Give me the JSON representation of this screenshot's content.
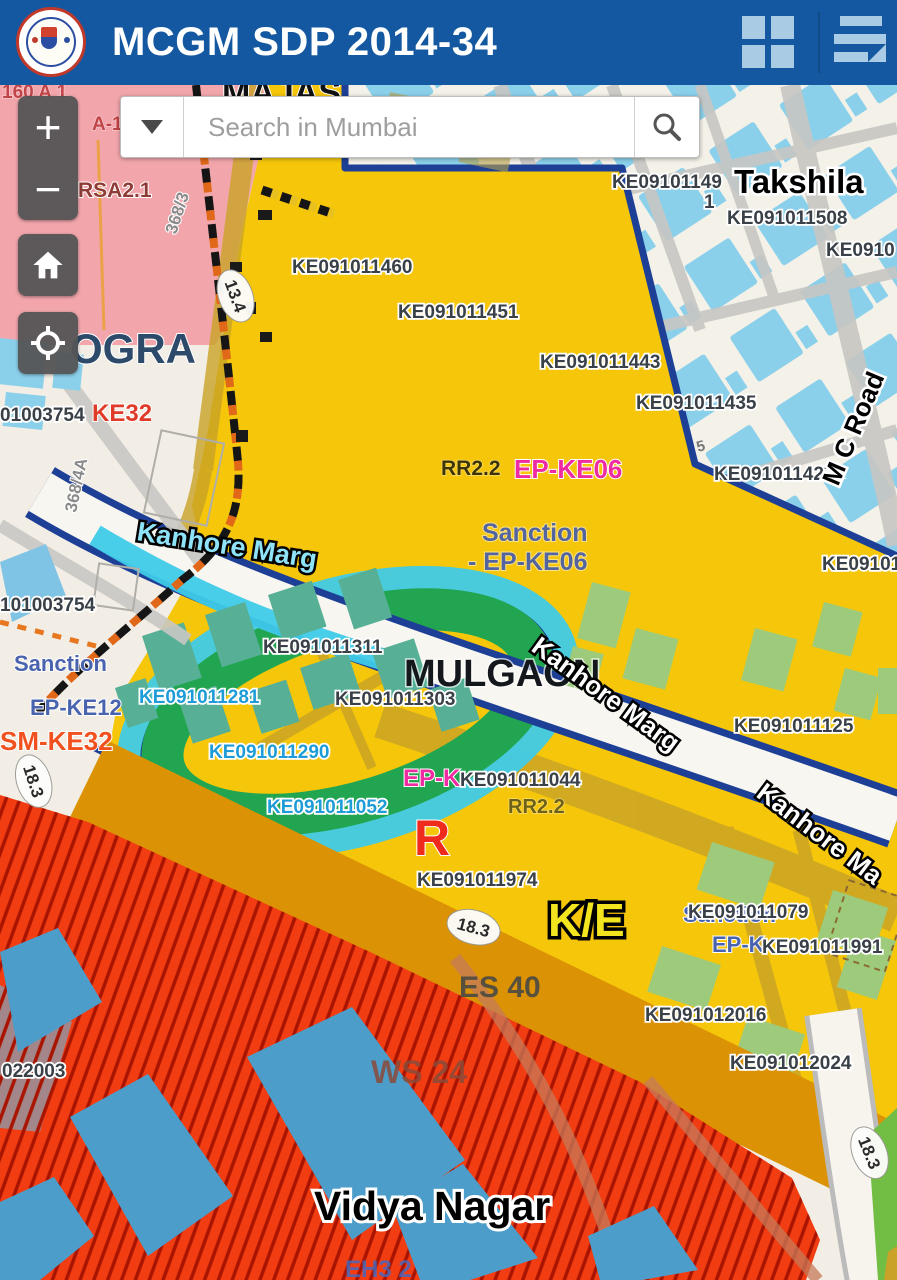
{
  "header": {
    "title": "MCGM SDP 2014-34",
    "grid_icon": "grid-icon",
    "menu_icon": "menu-icon",
    "bg_color": "#1358A0",
    "icon_color": "#A9CBE3"
  },
  "search": {
    "placeholder": "Search in Mumbai",
    "dropdown_icon": "chevron-down-icon",
    "search_icon": "search-icon"
  },
  "controls": {
    "zoom_in": "+",
    "zoom_out": "−",
    "home_icon": "home-icon",
    "locate_icon": "locate-icon"
  },
  "palette": {
    "zone_yellow": "#F5C60A",
    "zone_pink": "#F2A6AC",
    "zone_red_hatch": "#F23D12",
    "zone_orange_band": "#DB9204",
    "zone_green_ring": "#22A551",
    "building_light_blue": "#8BD0EB",
    "building_blue": "#4D9DCB",
    "building_teal": "#57B096",
    "building_green": "#9DCB7B",
    "boundary_navy": "#1D3F96",
    "road_gold": "#C9A227",
    "cyan_band": "#3FCBE8",
    "base": "#F2EEE5"
  },
  "map": {
    "labels": [
      {
        "t": "MAJAS",
        "x": 222,
        "y": 104,
        "c": "place-big"
      },
      {
        "t": "160 A 1",
        "x": 2,
        "y": 98,
        "c": "red-small"
      },
      {
        "t": "A-1",
        "x": 92,
        "y": 130,
        "c": "red-small"
      },
      {
        "t": "RSA2.1",
        "x": 78,
        "y": 197,
        "c": "maroon"
      },
      {
        "t": "368/3",
        "x": 176,
        "y": 235,
        "c": "gray-rot",
        "r": -72
      },
      {
        "t": "13.4",
        "x": 230,
        "y": 298,
        "c": "badge-text",
        "b": 1,
        "r": 70
      },
      {
        "t": "OGRA",
        "x": 70,
        "y": 363,
        "c": "ogra"
      },
      {
        "t": "01003754",
        "x": 0,
        "y": 421,
        "c": "parcel"
      },
      {
        "t": "KE32",
        "x": 92,
        "y": 421,
        "c": "ke32"
      },
      {
        "t": "368/4A",
        "x": 76,
        "y": 513,
        "c": "gray-rot",
        "r": -78
      },
      {
        "t": "101003754",
        "x": 0,
        "y": 611,
        "c": "parcel"
      },
      {
        "t": "Sanction",
        "x": 14,
        "y": 671,
        "c": "sanction"
      },
      {
        "t": "EP-KE12",
        "x": 30,
        "y": 715,
        "c": "sanction"
      },
      {
        "t": "SM-KE32",
        "x": 0,
        "y": 750,
        "c": "smke32"
      },
      {
        "t": "18.3",
        "x": 28,
        "y": 783,
        "c": "badge-text",
        "b": 1,
        "r": 72
      },
      {
        "t": "Kanhore Marg",
        "x": 136,
        "y": 540,
        "c": "road-cyan",
        "r": 9
      },
      {
        "t": "KE091011460",
        "x": 292,
        "y": 273,
        "c": "parcel"
      },
      {
        "t": "KE091011451",
        "x": 398,
        "y": 318,
        "c": "parcel"
      },
      {
        "t": "KE091011443",
        "x": 540,
        "y": 368,
        "c": "parcel"
      },
      {
        "t": "KE091011435",
        "x": 636,
        "y": 409,
        "c": "parcel"
      },
      {
        "t": "KE09101149",
        "x": 612,
        "y": 188,
        "c": "parcel"
      },
      {
        "t": "1",
        "x": 704,
        "y": 208,
        "c": "parcel"
      },
      {
        "t": "Takshila",
        "x": 734,
        "y": 193,
        "c": "takshila"
      },
      {
        "t": "KE091011508",
        "x": 727,
        "y": 224,
        "c": "parcel"
      },
      {
        "t": "KE0910",
        "x": 826,
        "y": 256,
        "c": "parcel"
      },
      {
        "t": "KE091011427",
        "x": 714,
        "y": 480,
        "c": "parcel"
      },
      {
        "t": "M C Road",
        "x": 838,
        "y": 487,
        "c": "road-black",
        "r": -67
      },
      {
        "t": "KE09101",
        "x": 822,
        "y": 570,
        "c": "parcel"
      },
      {
        "t": "5",
        "x": 698,
        "y": 452,
        "c": "gray-sm",
        "r": -15
      },
      {
        "t": "RR2.2",
        "x": 441,
        "y": 475,
        "c": "rr-dark"
      },
      {
        "t": "EP-KE06",
        "x": 514,
        "y": 478,
        "c": "magenta"
      },
      {
        "t": "Sanction",
        "x": 482,
        "y": 541,
        "c": "sanction-big"
      },
      {
        "t": "- EP-KE06",
        "x": 468,
        "y": 570,
        "c": "sanction-big"
      },
      {
        "t": "MULGAON",
        "x": 404,
        "y": 686,
        "c": "mulgaon"
      },
      {
        "t": "Kanhore Marg",
        "x": 530,
        "y": 650,
        "c": "road-white",
        "r": 36
      },
      {
        "t": "KE091011311",
        "x": 263,
        "y": 653,
        "c": "parcel"
      },
      {
        "t": "KE091011281",
        "x": 139,
        "y": 703,
        "c": "parcel-cyan"
      },
      {
        "t": "KE091011303",
        "x": 335,
        "y": 705,
        "c": "parcel"
      },
      {
        "t": "KE091011290",
        "x": 209,
        "y": 758,
        "c": "parcel-cyan"
      },
      {
        "t": "EP-K",
        "x": 403,
        "y": 786,
        "c": "magenta-sm"
      },
      {
        "t": "KE091011044",
        "x": 460,
        "y": 786,
        "c": "parcel"
      },
      {
        "t": "KE091011052",
        "x": 267,
        "y": 813,
        "c": "parcel-cyan"
      },
      {
        "t": "RR2.2",
        "x": 508,
        "y": 813,
        "c": "rr-olive"
      },
      {
        "t": "R",
        "x": 414,
        "y": 855,
        "c": "r-letter"
      },
      {
        "t": "KE091011125",
        "x": 734,
        "y": 732,
        "c": "parcel"
      },
      {
        "t": "Kanhore Ma",
        "x": 755,
        "y": 796,
        "c": "road-white",
        "r": 37
      },
      {
        "t": "KE091011974",
        "x": 417,
        "y": 886,
        "c": "parcel"
      },
      {
        "t": "K/E",
        "x": 548,
        "y": 936,
        "c": "ke-big"
      },
      {
        "t": "18.3",
        "x": 472,
        "y": 933,
        "c": "badge-text",
        "b": 1,
        "r": 15
      },
      {
        "t": "Sanction",
        "x": 683,
        "y": 922,
        "c": "sanction"
      },
      {
        "t": "KE091011079",
        "x": 688,
        "y": 918,
        "c": "parcel"
      },
      {
        "t": "EP-K",
        "x": 712,
        "y": 952,
        "c": "sanction"
      },
      {
        "t": "KE091011991",
        "x": 762,
        "y": 953,
        "c": "parcel"
      },
      {
        "t": "ES 40",
        "x": 459,
        "y": 997,
        "c": "es40"
      },
      {
        "t": "KE091012016",
        "x": 645,
        "y": 1021,
        "c": "parcel"
      },
      {
        "t": "KE091012024",
        "x": 730,
        "y": 1069,
        "c": "parcel"
      },
      {
        "t": "022003",
        "x": 2,
        "y": 1077,
        "c": "parcel"
      },
      {
        "t": "WS 24",
        "x": 371,
        "y": 1083,
        "c": "ws24"
      },
      {
        "t": "Vidya Nagar",
        "x": 314,
        "y": 1220,
        "c": "vidya"
      },
      {
        "t": "EH3 2",
        "x": 345,
        "y": 1277,
        "c": "eh3"
      },
      {
        "t": "18.3",
        "x": 864,
        "y": 1155,
        "c": "badge-text",
        "b": 1,
        "r": 68
      }
    ]
  }
}
